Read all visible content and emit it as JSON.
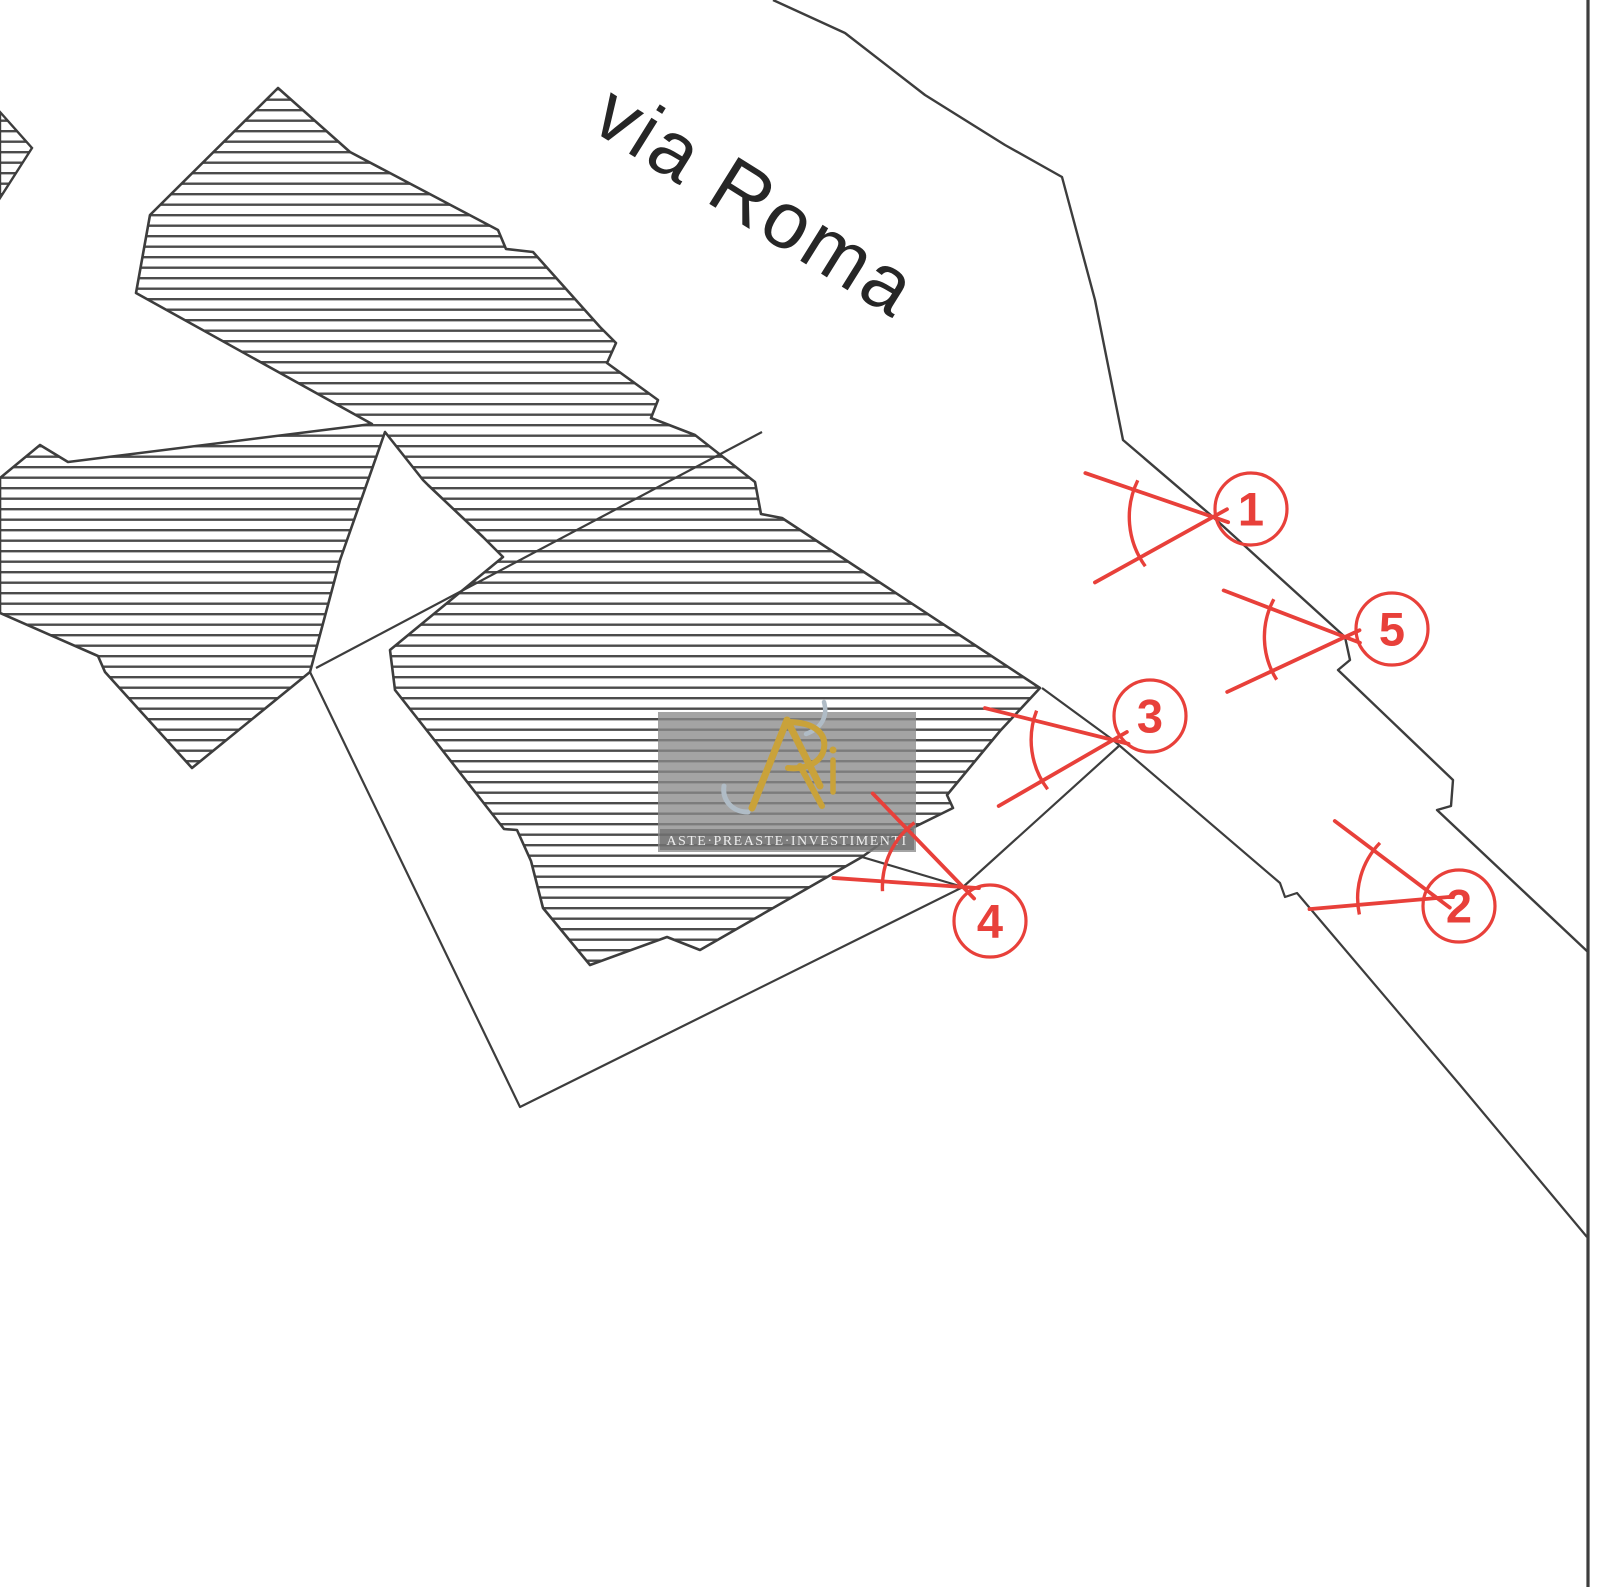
{
  "map": {
    "street_label": {
      "text": "via Roma",
      "x": 588,
      "y": 128,
      "rotation": 32,
      "font_size": 80
    },
    "watermark": {
      "text": "ASTE·PREASTE·INVESTIMENTI",
      "box": {
        "x": 658,
        "y": 712,
        "w": 258,
        "h": 140
      }
    },
    "colors": {
      "line": "#3d3d3d",
      "hatch": "#4b4b4b",
      "marker_red": "#e8403a",
      "background": "#ffffff",
      "watermark_bg": "#8a8a8a",
      "watermark_band": "#5f5f5f",
      "watermark_text": "#ededed",
      "logo_gold": "#c9a23a",
      "logo_silver": "#b0bcc6"
    },
    "building": {
      "name": "hatched-building-footprint",
      "points": [
        [
          278,
          88
        ],
        [
          350,
          152
        ],
        [
          498,
          230
        ],
        [
          506,
          249
        ],
        [
          533,
          252
        ],
        [
          600,
          327
        ],
        [
          616,
          343
        ],
        [
          607,
          363
        ],
        [
          658,
          400
        ],
        [
          651,
          418
        ],
        [
          695,
          435
        ],
        [
          755,
          482
        ],
        [
          761,
          514
        ],
        [
          782,
          518
        ],
        [
          1040,
          688
        ],
        [
          1000,
          731
        ],
        [
          947,
          795
        ],
        [
          953,
          808
        ],
        [
          880,
          844
        ],
        [
          862,
          857
        ],
        [
          700,
          950
        ],
        [
          667,
          937
        ],
        [
          590,
          965
        ],
        [
          543,
          908
        ],
        [
          531,
          861
        ],
        [
          517,
          830
        ],
        [
          504,
          829
        ],
        [
          432,
          737
        ],
        [
          395,
          690
        ],
        [
          390,
          650
        ],
        [
          503,
          557
        ],
        [
          483,
          537
        ],
        [
          428,
          485
        ],
        [
          423,
          480
        ],
        [
          385,
          432
        ],
        [
          340,
          560
        ],
        [
          310,
          672
        ],
        [
          192,
          768
        ],
        [
          105,
          672
        ],
        [
          98,
          656
        ],
        [
          0,
          613
        ],
        [
          0,
          478
        ],
        [
          40,
          445
        ],
        [
          68,
          462
        ],
        [
          372,
          424
        ],
        [
          136,
          293
        ],
        [
          150,
          215
        ]
      ]
    },
    "annex": {
      "name": "hatched-annex-fragment",
      "points": [
        [
          0,
          112
        ],
        [
          32,
          148
        ],
        [
          0,
          198
        ]
      ]
    },
    "lines": [
      {
        "name": "road-edge-upper",
        "width": 2.4,
        "points": [
          [
            773,
            0
          ],
          [
            845,
            33
          ],
          [
            925,
            95
          ],
          [
            1005,
            145
          ],
          [
            1062,
            177
          ],
          [
            1095,
            300
          ],
          [
            1123,
            440
          ],
          [
            1213,
            517
          ],
          [
            1345,
            637
          ],
          [
            1350,
            660
          ],
          [
            1338,
            670
          ],
          [
            1453,
            780
          ],
          [
            1451,
            806
          ],
          [
            1437,
            810
          ],
          [
            1588,
            952
          ]
        ]
      },
      {
        "name": "boundary-stepped-lower",
        "width": 2.2,
        "points": [
          [
            1042,
            688
          ],
          [
            1113,
            740
          ],
          [
            1280,
            883
          ],
          [
            1285,
            897
          ],
          [
            1297,
            893
          ],
          [
            1460,
            1085
          ],
          [
            1587,
            1237
          ]
        ]
      },
      {
        "name": "parcel-v-boundary",
        "width": 2.2,
        "points": [
          [
            310,
            672
          ],
          [
            520,
            1107
          ],
          [
            963,
            887
          ],
          [
            1120,
            745
          ]
        ]
      },
      {
        "name": "corner-link-line",
        "width": 2.2,
        "points": [
          [
            862,
            857
          ],
          [
            963,
            887
          ]
        ]
      },
      {
        "name": "internal-parcel-line",
        "width": 2.2,
        "points": [
          [
            762,
            432
          ],
          [
            316,
            668
          ]
        ]
      },
      {
        "name": "right-frame-border",
        "width": 3.2,
        "points": [
          [
            1588,
            0
          ],
          [
            1588,
            1587
          ]
        ]
      }
    ],
    "markers": [
      {
        "label": "1",
        "apex": [
          1213,
          517
        ],
        "axis": 175,
        "spread": 48,
        "length": 135,
        "circle": [
          1251,
          509
        ],
        "r": 36
      },
      {
        "label": "5",
        "apex": [
          1345,
          637
        ],
        "axis": 178,
        "spread": 46,
        "length": 130,
        "circle": [
          1392,
          629
        ],
        "r": 36
      },
      {
        "label": "3",
        "apex": [
          1113,
          740
        ],
        "axis": 172,
        "spread": 44,
        "length": 132,
        "circle": [
          1150,
          716
        ],
        "r": 36
      },
      {
        "label": "4",
        "apex": [
          963,
          887
        ],
        "axis": 205,
        "spread": 42,
        "length": 130,
        "circle": [
          990,
          921
        ],
        "r": 36
      },
      {
        "label": "2",
        "apex": [
          1437,
          898
        ],
        "axis": 196,
        "spread": 42,
        "length": 128,
        "circle": [
          1459,
          906
        ],
        "r": 36
      }
    ]
  }
}
